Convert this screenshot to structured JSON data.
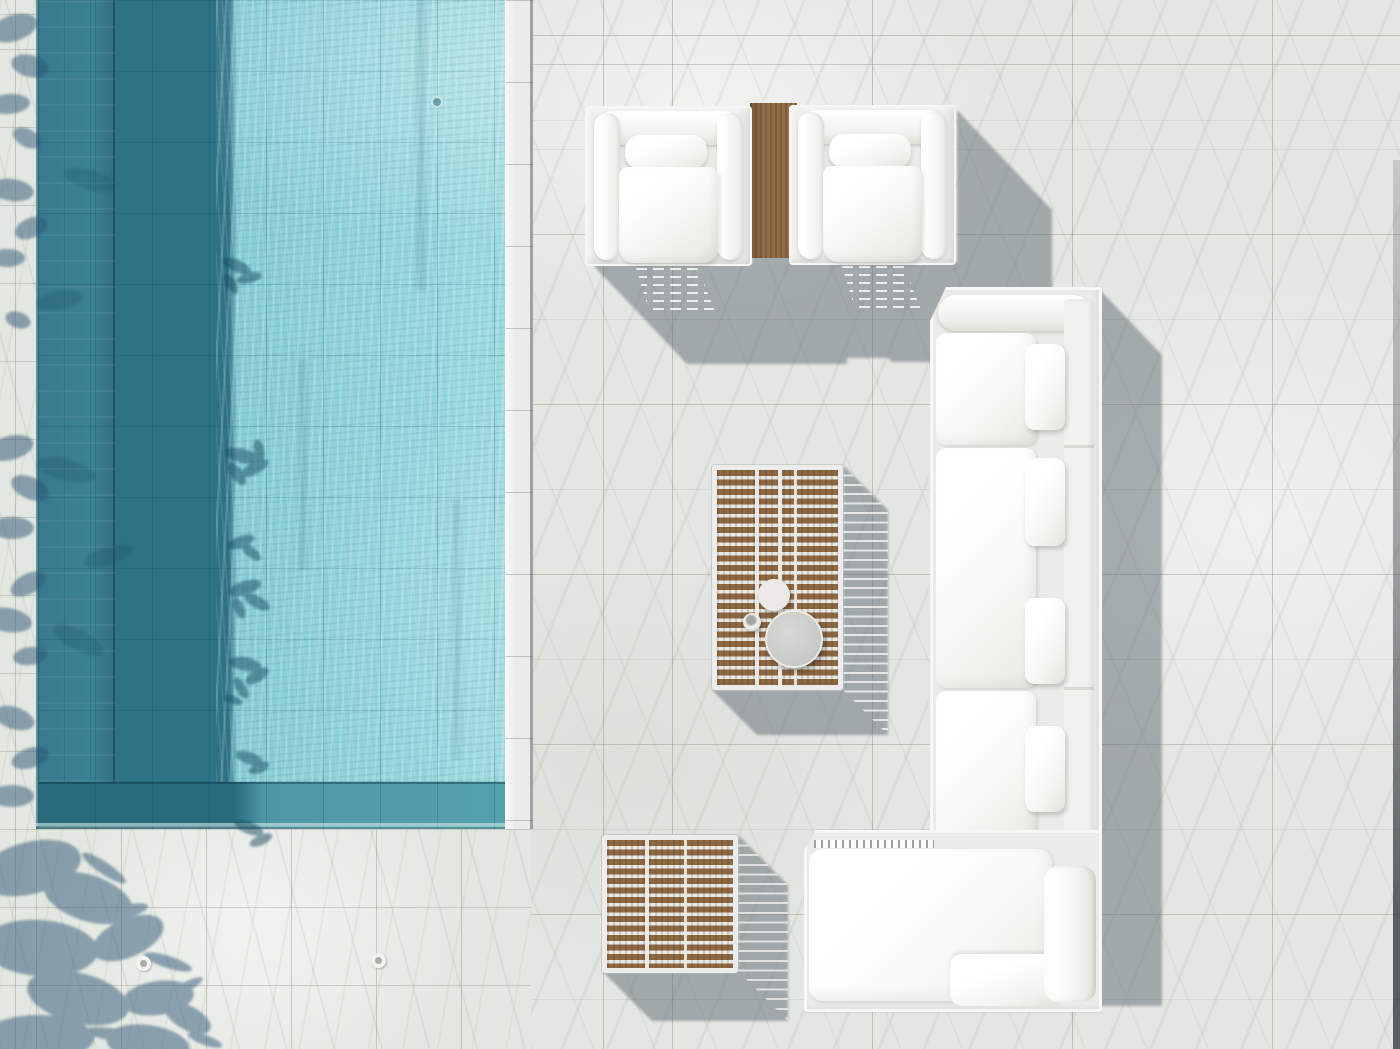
{
  "scene": {
    "description": "Aerial top-down photograph of a white marble pool terrace with white aluminum-and-cushion outdoor lounge furniture, teak slat tables, and a turquoise swimming pool along the left side",
    "lighting": "strong midday sun from upper left, hard shadows cast toward lower right",
    "objects": [
      {
        "id": "swimming-pool",
        "label": "Swimming pool with rippled turquoise water, shaded along its left wall"
      },
      {
        "id": "pool-coping",
        "label": "White marble pool coping strip"
      },
      {
        "id": "marble-deck",
        "label": "White marble tile terrace"
      },
      {
        "id": "armchair-left",
        "label": "White cushioned lounge armchair"
      },
      {
        "id": "armchair-right",
        "label": "White cushioned lounge armchair"
      },
      {
        "id": "mini-side-table",
        "label": "Teak side table between armchairs"
      },
      {
        "id": "coffee-table",
        "label": "Teak slat-top coffee table"
      },
      {
        "id": "tray-large",
        "label": "Round gray serving tray"
      },
      {
        "id": "bowl",
        "label": "White round bowl"
      },
      {
        "id": "cup",
        "label": "Small white cup"
      },
      {
        "id": "side-table",
        "label": "Teak slat-top side table"
      },
      {
        "id": "sectional-sofa",
        "label": "L-shaped white outdoor sectional sofa with chaise"
      },
      {
        "id": "tree-shadows",
        "label": "Tree and palm foliage shadows along the left edge and pool"
      },
      {
        "id": "deck-drains",
        "label": "Two small round deck drains"
      }
    ]
  },
  "palette": {
    "marble": "#e4e6e2",
    "marble-left": "#e3e7e1",
    "coping": "#eaece9",
    "pool-lit": "#95d6dc",
    "pool-mid": "#77c0cc",
    "pool-shadow": "#2e7285",
    "pool-wall": "#3b8295",
    "pool-bottom-wall": "#4f97a6",
    "cushion": "#fafaf8",
    "frame": "#ebece8",
    "wood": "#946e47",
    "wood-dark": "#8d6843",
    "tray": "#c8cac6",
    "cast-shadow": "#5a656d",
    "tree-shadow": "#2e5674"
  }
}
